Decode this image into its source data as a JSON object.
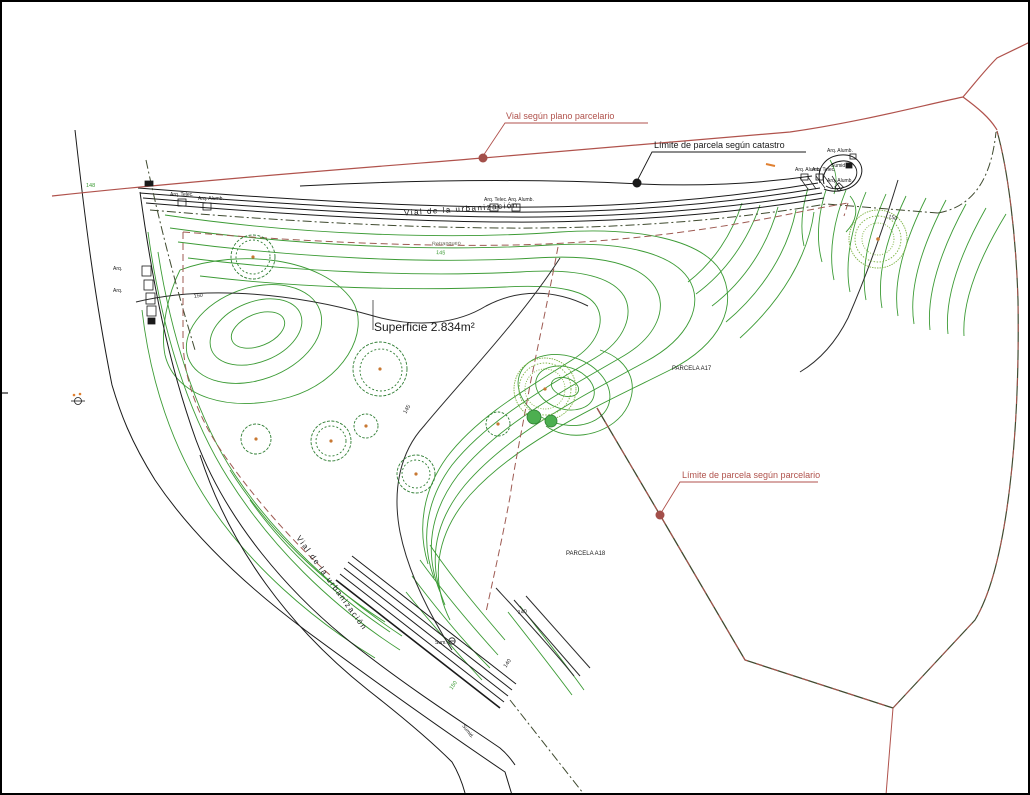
{
  "title": "Plano topográfico de parcela",
  "labels": {
    "vial_parcelario": "Vial según plano parcelario",
    "limite_catastro": "Límite de parcela según catastro",
    "limite_parcelario": "Límite de parcela según parcelario",
    "vial_urbanizacion_top": "Vial  de  la  urbanización",
    "vial_urbanizacion_left": "Vial  de  la  urbanización",
    "superficie": "Superficie 2.834m²",
    "parcela_a17": "PARCELA A17",
    "parcela_a18": "PARCELA A18",
    "retranqueo": "Retranqueo"
  },
  "utilities": {
    "arq_telec": "Arq. Telec.",
    "arq_alumb": "Arq. Alumb.",
    "sumid": "Sumid.",
    "sum": "Sum.",
    "arq": "Arq."
  },
  "contour_labels": [
    {
      "text": "150"
    },
    {
      "text": "145"
    },
    {
      "text": "150"
    },
    {
      "text": "140"
    },
    {
      "text": "140"
    },
    {
      "text": "150"
    },
    {
      "text": "148"
    },
    {
      "text": "145"
    }
  ],
  "colors": {
    "contour_green": "#3c9b35",
    "light_green": "#7cb342",
    "road_black": "#1a1a1a",
    "index_contour": "#2b2b2b",
    "red_line": "#b0524c",
    "boundary_maroon": "#9e5a52",
    "catastro_dark": "#3f4a2f",
    "marker_orange": "#e08030",
    "tree_green": "#2e7d32",
    "background": "#ffffff"
  }
}
